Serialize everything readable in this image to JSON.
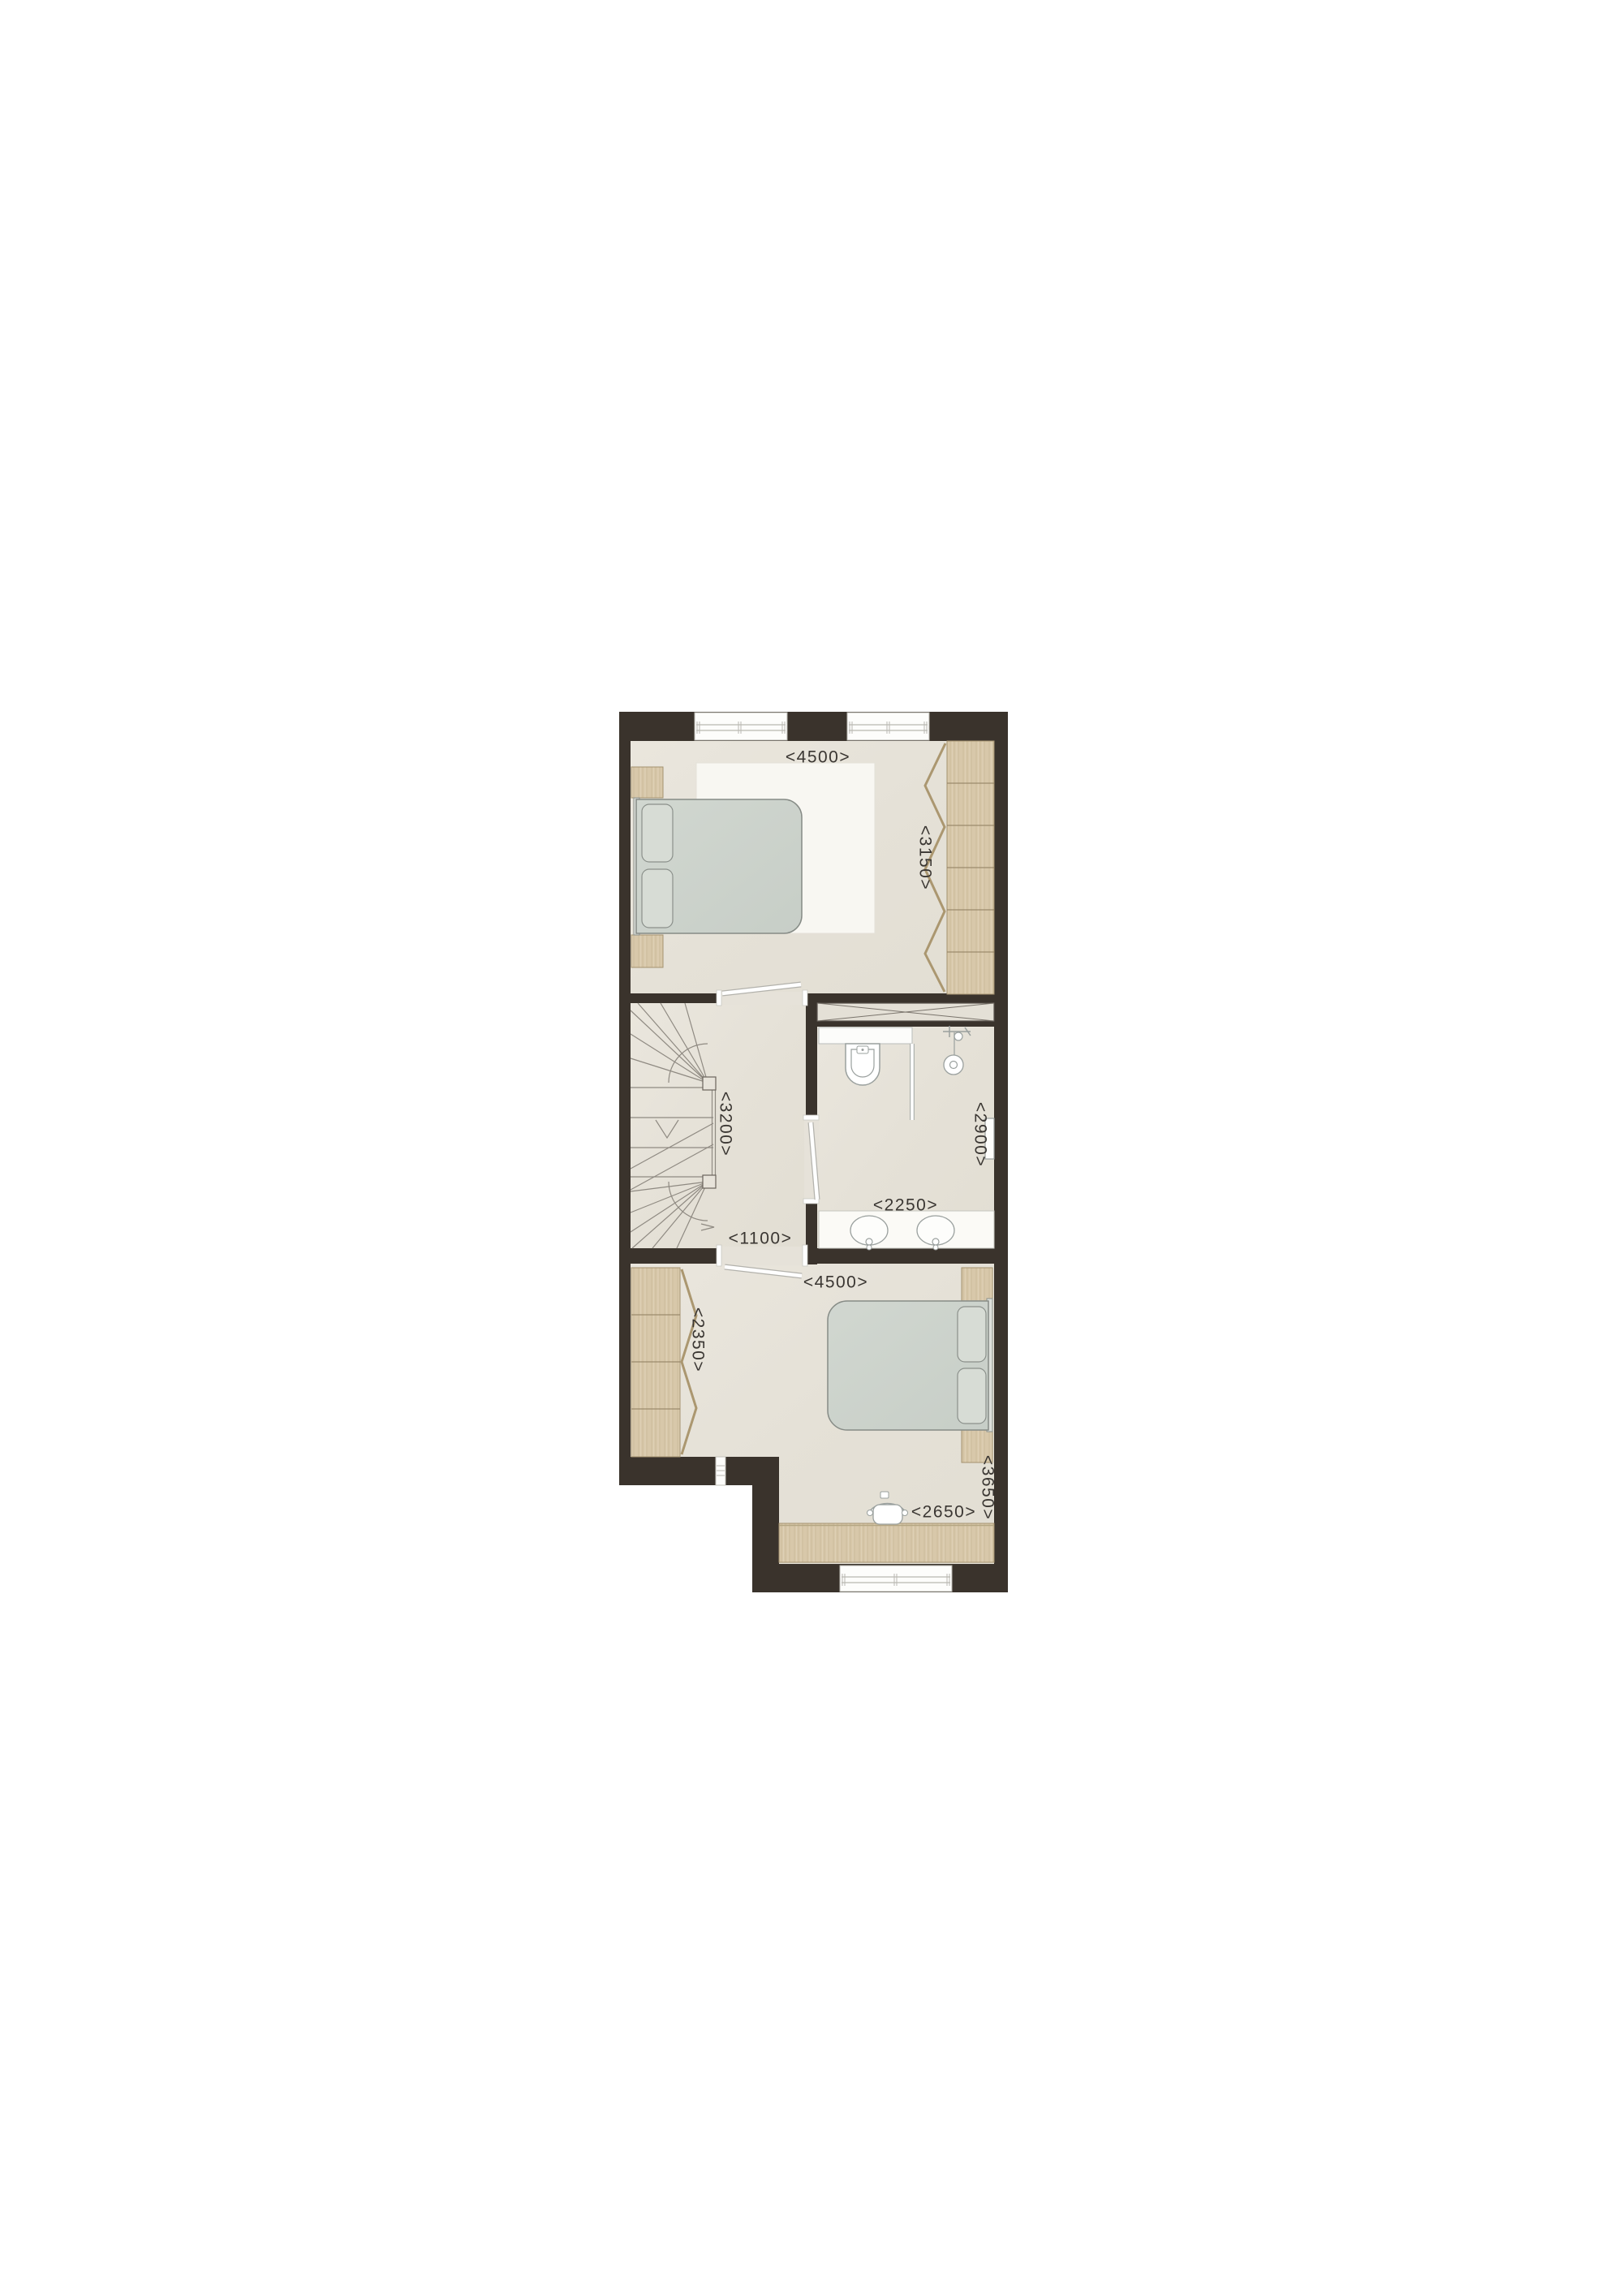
{
  "dimensions": {
    "upper_bedroom_width": "<4500>",
    "upper_bedroom_depth": "<3150>",
    "stairwell_depth": "<3200>",
    "landing_width": "<1100>",
    "bathroom_width": "<2250>",
    "bathroom_depth": "<2900>",
    "lower_bedroom_width": "<4500>",
    "lower_wardrobe_length": "<2350>",
    "lower_bedroom_depth": "<3650>",
    "desk_length": "<2650>"
  },
  "colors": {
    "background": "#ffffff",
    "wall": "#3a332c",
    "floor": "#e7e3da",
    "wood": "#d8c8aa",
    "bed": "#cdd3cc",
    "rug": "#f8f7f2",
    "fixture_outline": "#9aa09e",
    "dimension_text": "#3a3632"
  }
}
